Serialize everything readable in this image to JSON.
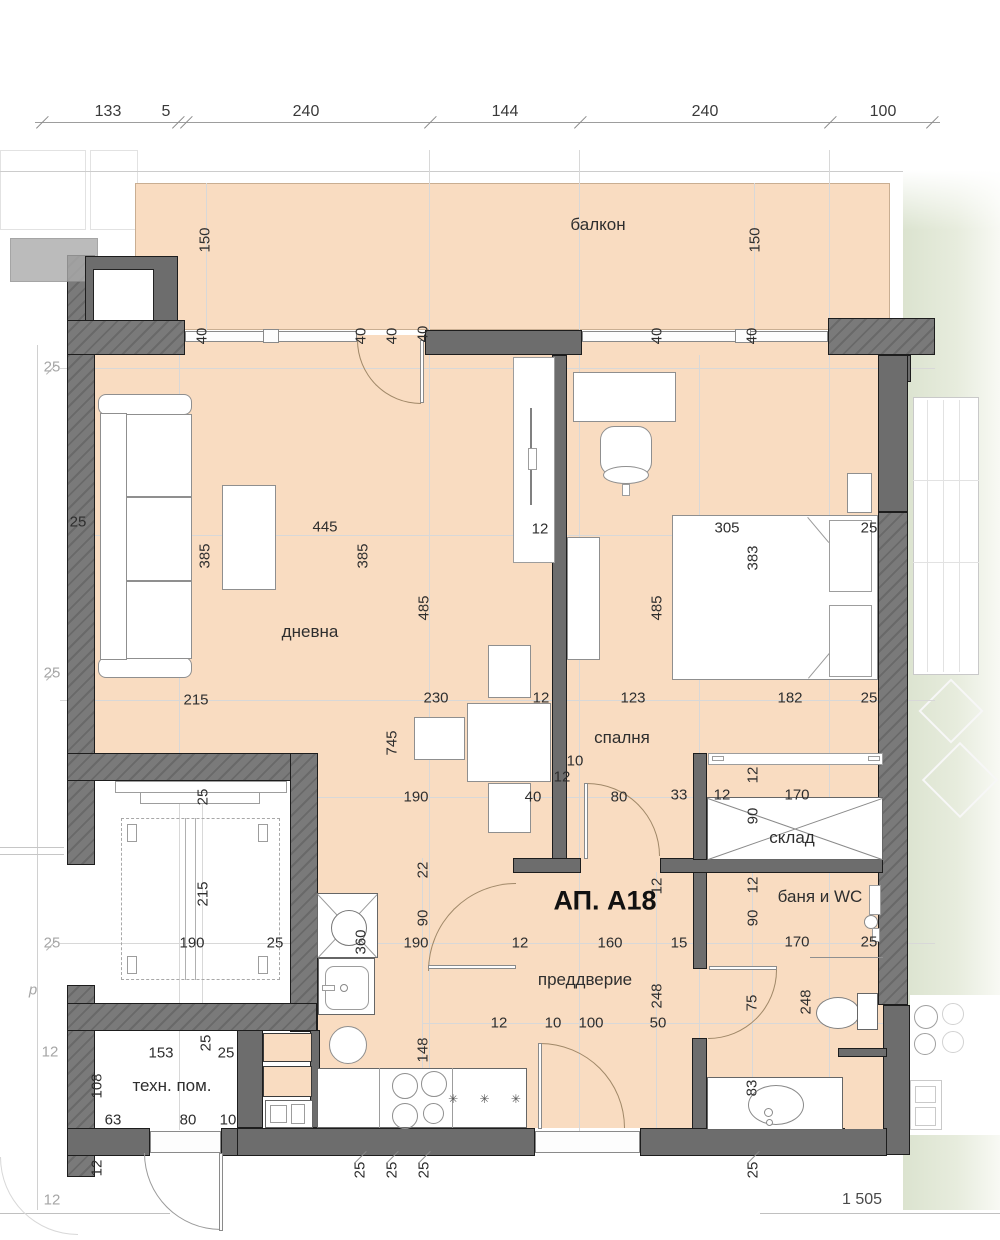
{
  "title": {
    "t": "АП. А18",
    "x": 605,
    "y": 901
  },
  "drawing_no": {
    "t": "1 505",
    "x": 862,
    "y": 1200
  },
  "rooms": [
    {
      "name": "балкон",
      "x": 598,
      "y": 225
    },
    {
      "name": "дневна",
      "x": 310,
      "y": 632
    },
    {
      "name": "спалня",
      "x": 622,
      "y": 738
    },
    {
      "name": "склад",
      "x": 792,
      "y": 838
    },
    {
      "name": "баня и WC",
      "x": 820,
      "y": 897
    },
    {
      "name": "преддверие",
      "x": 585,
      "y": 980
    },
    {
      "name": "техн. пом.",
      "x": 172,
      "y": 1086
    }
  ],
  "top_dimensions": {
    "y": 112,
    "items": [
      {
        "t": "133",
        "x": 108
      },
      {
        "t": "5",
        "x": 166
      },
      {
        "t": "240",
        "x": 306
      },
      {
        "t": "144",
        "x": 505
      },
      {
        "t": "240",
        "x": 705
      },
      {
        "t": "100",
        "x": 883
      }
    ]
  },
  "dimensions": [
    {
      "t": "150",
      "x": 205,
      "y": 240,
      "v": 1
    },
    {
      "t": "150",
      "x": 755,
      "y": 240,
      "v": 1
    },
    {
      "t": "40",
      "x": 202,
      "y": 336,
      "v": 1
    },
    {
      "t": "40",
      "x": 361,
      "y": 336,
      "v": 1
    },
    {
      "t": "40",
      "x": 392,
      "y": 336,
      "v": 1
    },
    {
      "t": "40",
      "x": 423,
      "y": 334,
      "v": 1
    },
    {
      "t": "40",
      "x": 657,
      "y": 336,
      "v": 1
    },
    {
      "t": "40",
      "x": 752,
      "y": 336,
      "v": 1
    },
    {
      "t": "25",
      "x": 52,
      "y": 367,
      "g": 1
    },
    {
      "t": "25",
      "x": 78,
      "y": 522
    },
    {
      "t": "445",
      "x": 325,
      "y": 527
    },
    {
      "t": "385",
      "x": 205,
      "y": 556,
      "v": 1
    },
    {
      "t": "385",
      "x": 363,
      "y": 556,
      "v": 1
    },
    {
      "t": "12",
      "x": 540,
      "y": 529
    },
    {
      "t": "305",
      "x": 727,
      "y": 528
    },
    {
      "t": "383",
      "x": 753,
      "y": 558,
      "v": 1
    },
    {
      "t": "25",
      "x": 869,
      "y": 528
    },
    {
      "t": "485",
      "x": 424,
      "y": 608,
      "v": 1
    },
    {
      "t": "485",
      "x": 657,
      "y": 608,
      "v": 1
    },
    {
      "t": "25",
      "x": 52,
      "y": 673,
      "g": 1
    },
    {
      "t": "215",
      "x": 196,
      "y": 700
    },
    {
      "t": "230",
      "x": 436,
      "y": 698
    },
    {
      "t": "12",
      "x": 541,
      "y": 698
    },
    {
      "t": "123",
      "x": 633,
      "y": 698
    },
    {
      "t": "182",
      "x": 790,
      "y": 698
    },
    {
      "t": "25",
      "x": 869,
      "y": 698
    },
    {
      "t": "745",
      "x": 392,
      "y": 743,
      "v": 1
    },
    {
      "t": "10",
      "x": 575,
      "y": 761
    },
    {
      "t": "12",
      "x": 562,
      "y": 777
    },
    {
      "t": "190",
      "x": 416,
      "y": 797
    },
    {
      "t": "40",
      "x": 533,
      "y": 797
    },
    {
      "t": "80",
      "x": 619,
      "y": 797
    },
    {
      "t": "33",
      "x": 679,
      "y": 795
    },
    {
      "t": "12",
      "x": 722,
      "y": 795
    },
    {
      "t": "170",
      "x": 797,
      "y": 795
    },
    {
      "t": "12",
      "x": 753,
      "y": 775,
      "v": 1
    },
    {
      "t": "90",
      "x": 753,
      "y": 816,
      "v": 1
    },
    {
      "t": "25",
      "x": 203,
      "y": 797,
      "v": 1
    },
    {
      "t": "215",
      "x": 203,
      "y": 894,
      "v": 1
    },
    {
      "t": "22",
      "x": 423,
      "y": 870,
      "v": 1
    },
    {
      "t": "90",
      "x": 423,
      "y": 918,
      "v": 1
    },
    {
      "t": "12",
      "x": 657,
      "y": 886,
      "v": 1
    },
    {
      "t": "12",
      "x": 753,
      "y": 885,
      "v": 1
    },
    {
      "t": "90",
      "x": 753,
      "y": 918,
      "v": 1
    },
    {
      "t": "360",
      "x": 361,
      "y": 942,
      "v": 1
    },
    {
      "t": "190",
      "x": 192,
      "y": 943
    },
    {
      "t": "25",
      "x": 275,
      "y": 943
    },
    {
      "t": "25",
      "x": 52,
      "y": 943,
      "g": 1
    },
    {
      "t": "190",
      "x": 416,
      "y": 943
    },
    {
      "t": "12",
      "x": 520,
      "y": 943
    },
    {
      "t": "160",
      "x": 610,
      "y": 943
    },
    {
      "t": "15",
      "x": 679,
      "y": 943
    },
    {
      "t": "170",
      "x": 797,
      "y": 942
    },
    {
      "t": "25",
      "x": 869,
      "y": 942
    },
    {
      "t": "248",
      "x": 657,
      "y": 996,
      "v": 1
    },
    {
      "t": "75",
      "x": 752,
      "y": 1003,
      "v": 1
    },
    {
      "t": "248",
      "x": 806,
      "y": 1002,
      "v": 1
    },
    {
      "t": "148",
      "x": 423,
      "y": 1050,
      "v": 1
    },
    {
      "t": "12",
      "x": 499,
      "y": 1023
    },
    {
      "t": "10",
      "x": 553,
      "y": 1023
    },
    {
      "t": "100",
      "x": 591,
      "y": 1023
    },
    {
      "t": "50",
      "x": 658,
      "y": 1023
    },
    {
      "t": "83",
      "x": 752,
      "y": 1088,
      "v": 1
    },
    {
      "t": "12",
      "x": 50,
      "y": 1052,
      "g": 1
    },
    {
      "t": "153",
      "x": 161,
      "y": 1053
    },
    {
      "t": "25",
      "x": 206,
      "y": 1043,
      "v": 1
    },
    {
      "t": "25",
      "x": 226,
      "y": 1053
    },
    {
      "t": "108",
      "x": 97,
      "y": 1086,
      "v": 1
    },
    {
      "t": "63",
      "x": 113,
      "y": 1120
    },
    {
      "t": "80",
      "x": 188,
      "y": 1120
    },
    {
      "t": "10",
      "x": 228,
      "y": 1120
    },
    {
      "t": "12",
      "x": 97,
      "y": 1168,
      "v": 1
    },
    {
      "t": "12",
      "x": 52,
      "y": 1200,
      "g": 1
    },
    {
      "t": "25",
      "x": 360,
      "y": 1170,
      "v": 1
    },
    {
      "t": "25",
      "x": 392,
      "y": 1170,
      "v": 1
    },
    {
      "t": "25",
      "x": 424,
      "y": 1170,
      "v": 1
    },
    {
      "t": "25",
      "x": 753,
      "y": 1170,
      "v": 1
    }
  ],
  "annotations": [
    {
      "t": "✳ ✳ ✳",
      "x": 489,
      "y": 1099,
      "stars": 1
    },
    {
      "t": "p",
      "x": 33,
      "y": 990,
      "g": 1
    }
  ],
  "colors": {
    "floor": "#f9dcc1",
    "wall": "#6d6d6d",
    "neighbor_green": "#dbe3cf",
    "dim_text": "#2e2e2e",
    "dim_text_faded": "#a6a6a6",
    "door_arc": "#a08868"
  }
}
